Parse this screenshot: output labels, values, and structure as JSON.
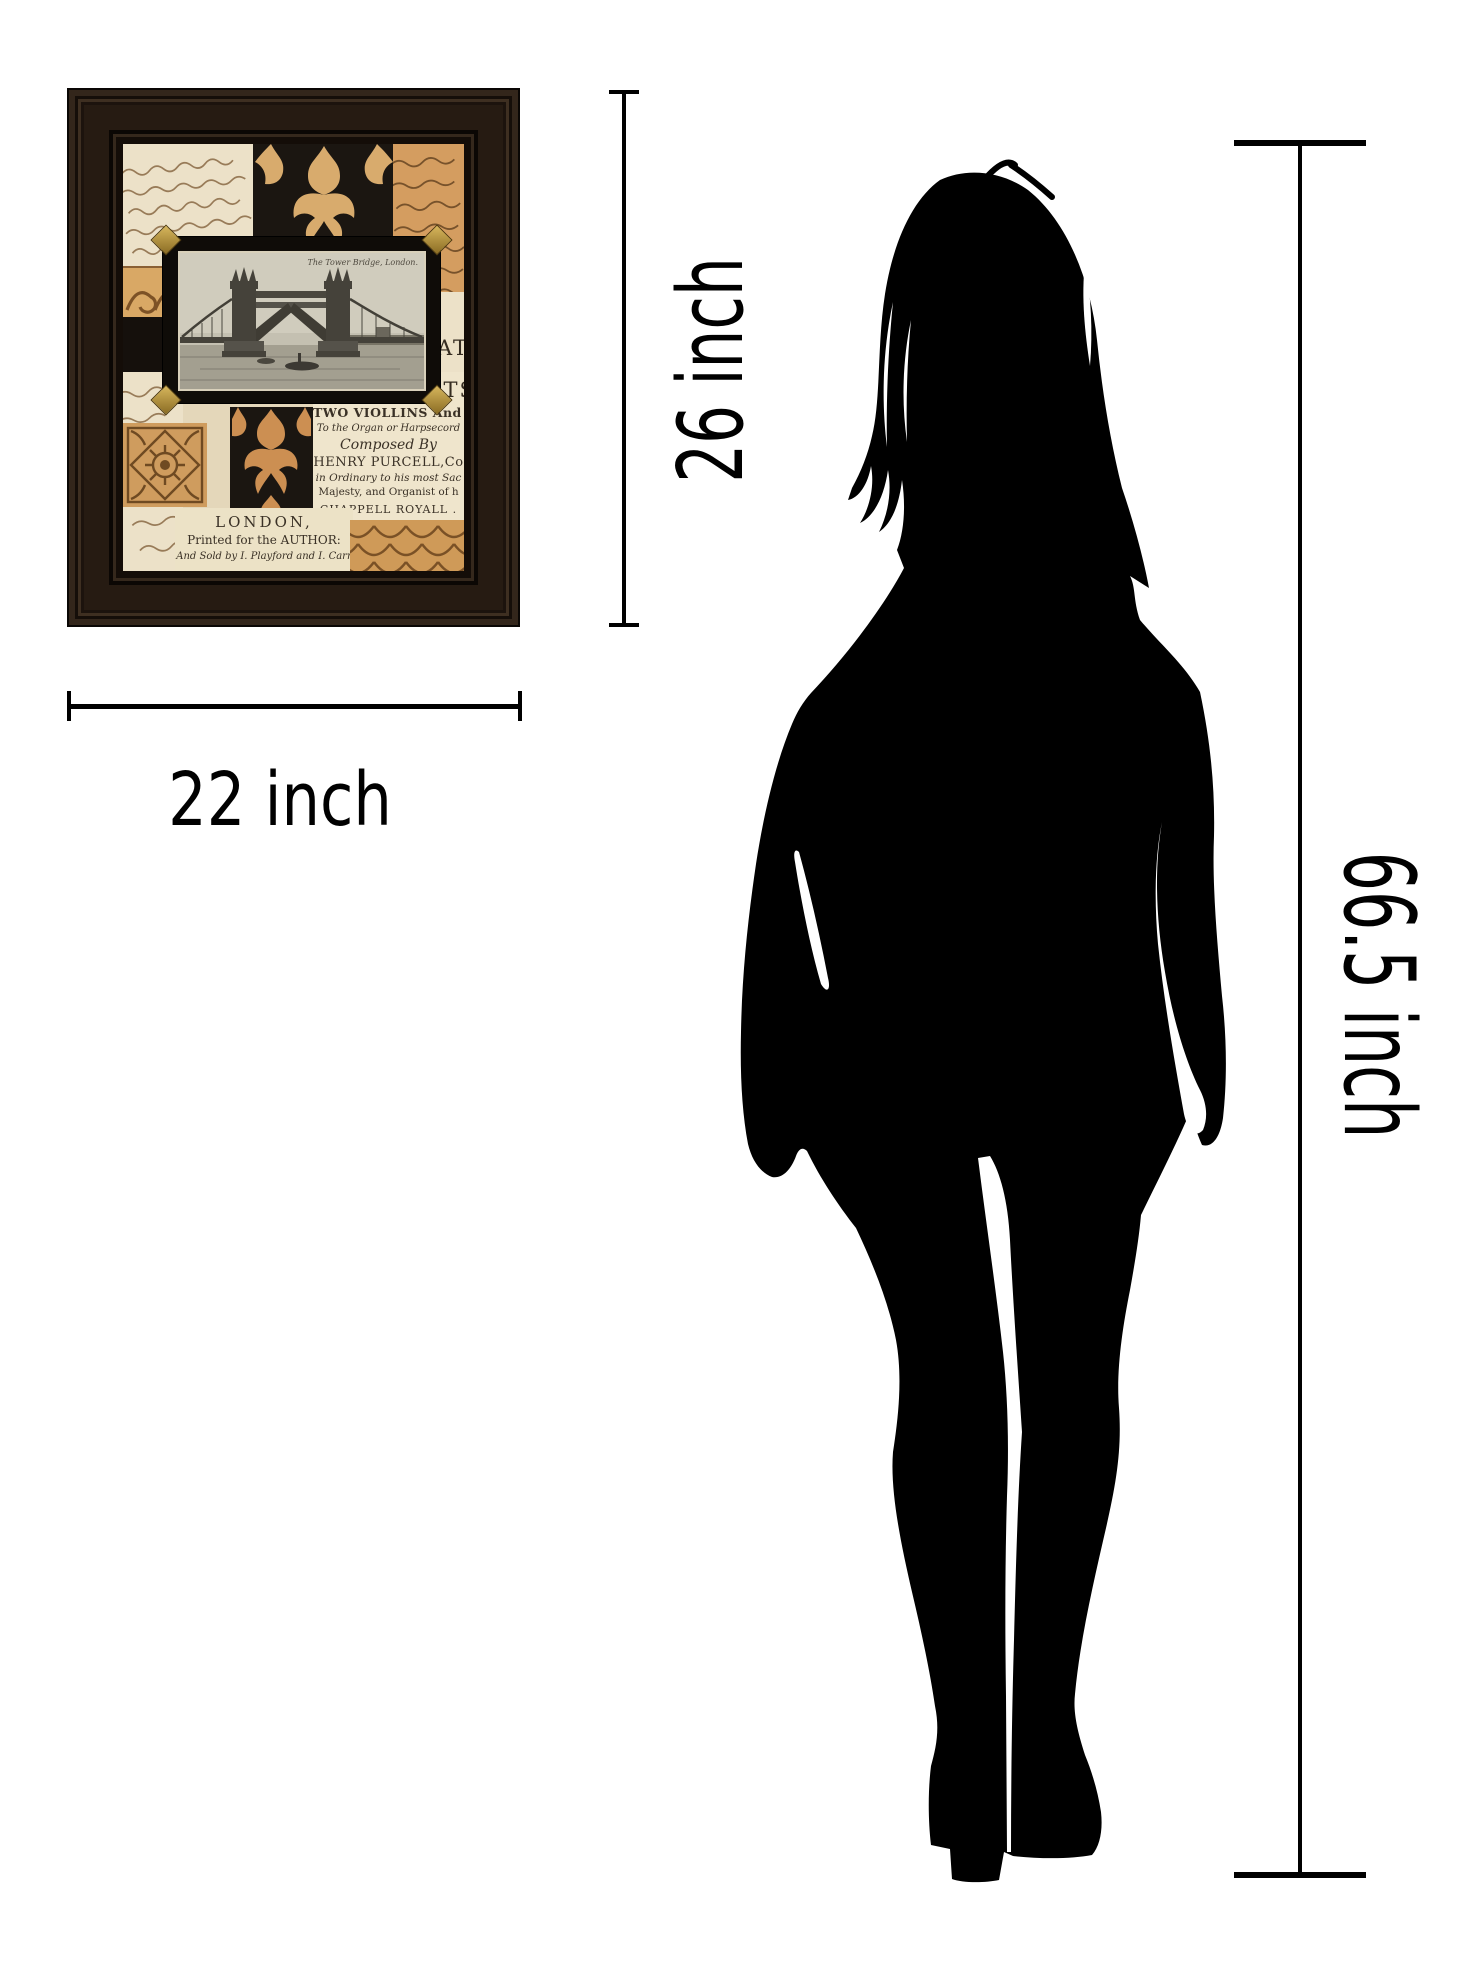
{
  "meta": {
    "kind": "product-size-comparison-image",
    "background": "#ffffff"
  },
  "colors": {
    "dimension_line": "#000000",
    "silhouette": "#000000",
    "frame": "#261b12",
    "paper_cream": "#ece1c8",
    "paper_orange": "#d49d60",
    "damask_tan": "#d8ab6d",
    "script_ink": "#8a6a45"
  },
  "dimension_labels": {
    "artwork_height": "26 inch",
    "artwork_width": "22 inch",
    "person_height": "66.5 inch"
  },
  "artwork": {
    "postcard_caption": "The Tower Bridge, London.",
    "big_letters_top": "ATA",
    "big_letters_bottom": "RTS",
    "line_violins": "TWO VIOLLINS And BA",
    "line_organ": "To the Organ or Harpsecord",
    "line_composed": "Composed By",
    "line_purcell": "HENRY PURCELL,Co",
    "line_ordinary": "in Ordinary to his most Sac",
    "line_majesty": "Majesty, and Organist of h",
    "line_chappell": "CHAPPELL ROYALL .",
    "line_london": "LONDON,",
    "line_printed": "Printed for the AUTHOR:",
    "line_sold": "And Sold by I. Playford and I. Carr"
  },
  "icons": {
    "product": "framed-collage-art",
    "figure": "woman-silhouette"
  }
}
